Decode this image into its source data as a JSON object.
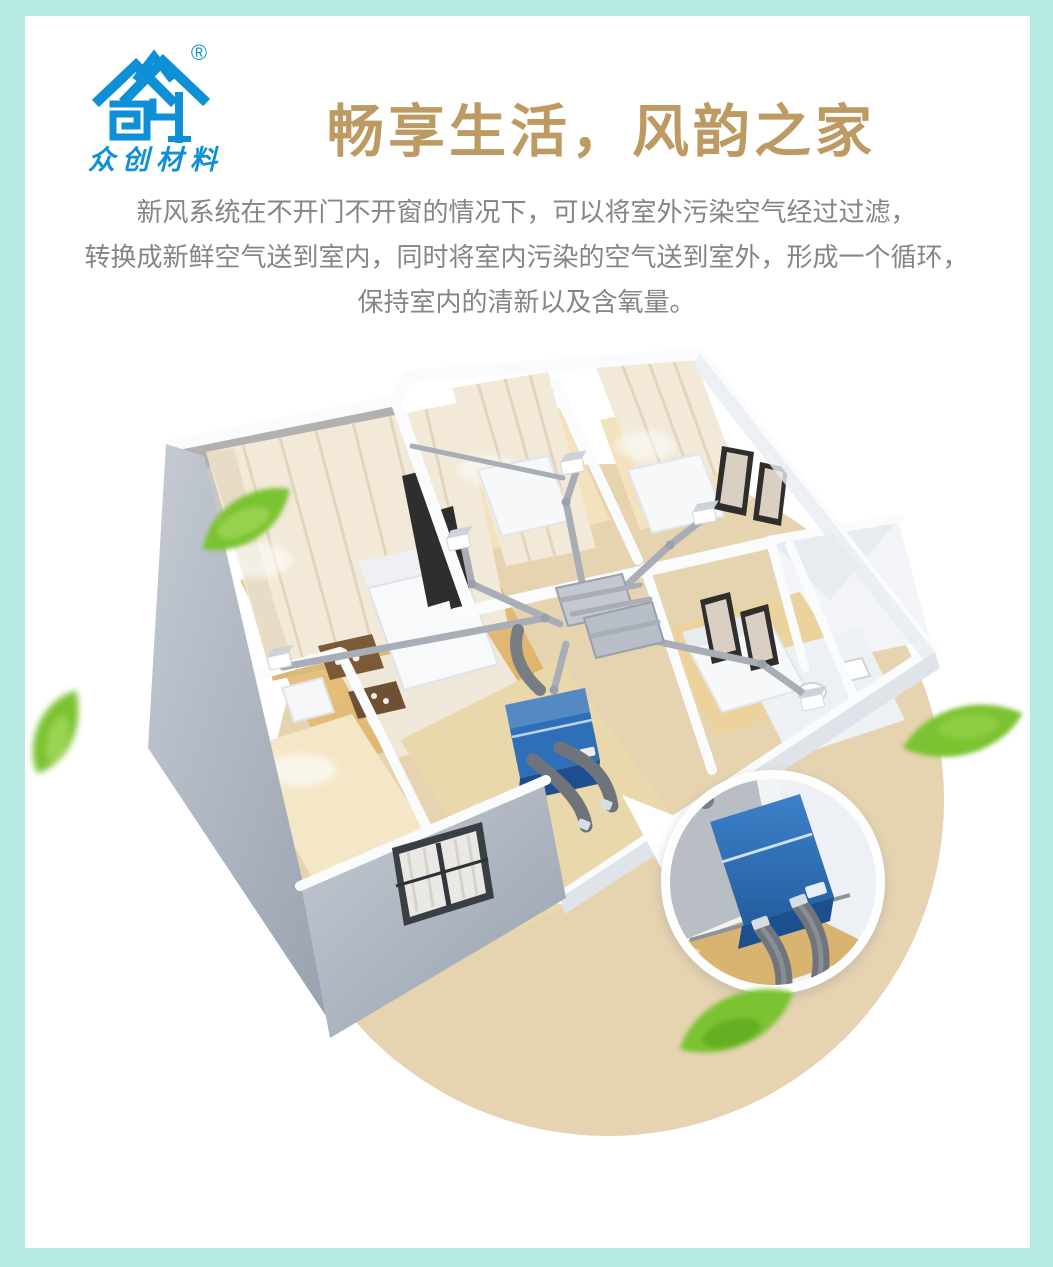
{
  "brand": {
    "name": "众创材料",
    "registered_mark": "®",
    "logo_color": "#0e90d7"
  },
  "hero": {
    "title": "畅享生活，风韵之家",
    "title_color": "#bd9a62"
  },
  "intro": {
    "text_color": "#858585",
    "lines": [
      "新风系统在不开门不开窗的情况下，可以将室外污染空气经过过滤，",
      "转换成新鲜空气送到室内，同时将室内污染的空气送到室外，形成一个循环，",
      "保持室内的清新以及含氧量。"
    ]
  },
  "illustration": {
    "subject": "fresh-air-system-3d-floorplan",
    "colors": {
      "frame_mint": "#b5e9e1",
      "circle_tan": "#e6d3b0",
      "unit_blue": "#2f6fb8",
      "unit_blue_dark": "#1d4f8e",
      "duct_gray": "#a9aeb6",
      "flex_duct_gray": "#6f747b",
      "leaf_green": "#7cc331",
      "outer_wall_gray": "#9aa4b2",
      "floor_wood": "#e9c588",
      "curtain_cream": "#f2e9d9"
    }
  }
}
